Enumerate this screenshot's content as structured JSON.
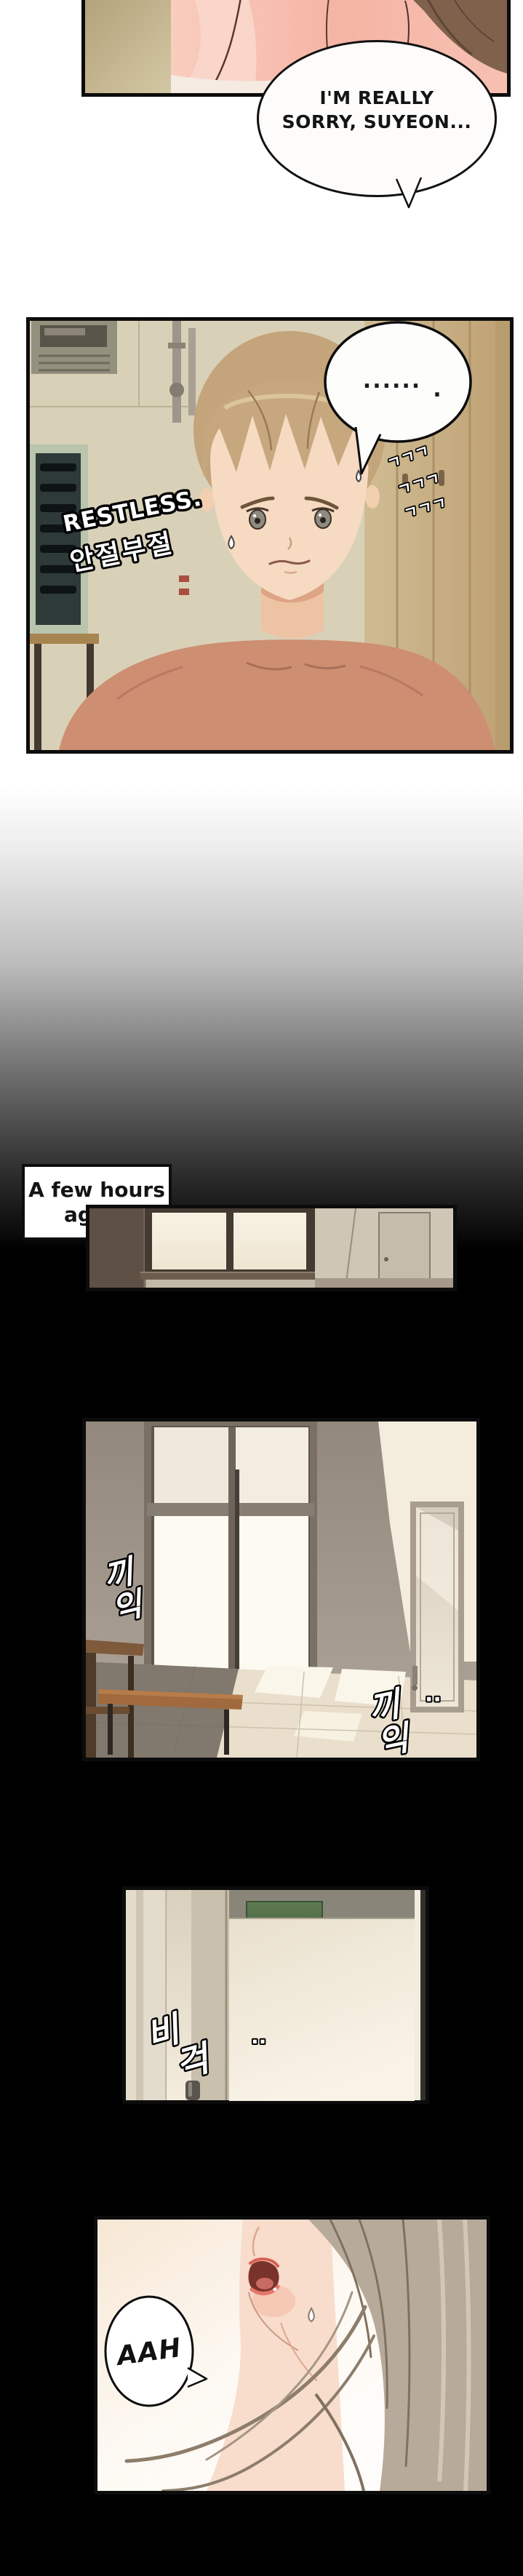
{
  "comic": {
    "panel1_bubble": {
      "line1": "I'M REALLY",
      "line2": "SORRY, SUYEON..."
    },
    "panel2": {
      "bubble_dots": "......",
      "bubble_period": ".",
      "zzz": [
        "ㄱㄱㄱ",
        "ㄱㄱㄱ",
        "ㄱㄱㄱ"
      ],
      "restless_en": "RESTLESS.",
      "restless_kr": "안절부절"
    },
    "caption": {
      "line1": "A few hours",
      "line2": "ago..."
    },
    "panel4": {
      "creak1_ch1": "끼",
      "creak1_ch2": "익",
      "creak2_ch1": "끼",
      "creak2_ch2": "익",
      "creak2_dots": "··"
    },
    "panel5": {
      "creak_ch1": "비",
      "creak_ch2": "걱",
      "dots": "··"
    },
    "panel6": {
      "moan": "AAH"
    }
  },
  "colors": {
    "panel_border": "#0c0c0c",
    "speech_bubble_fill": "#fdfcfb",
    "blackout": "#000000",
    "skin_salmon": "#cd8e72",
    "locker_wood": "#c9b38a",
    "door_sign_green": "#5e7b54",
    "sfx_fill": "#ffffff",
    "sfx_outline": "#000000"
  }
}
